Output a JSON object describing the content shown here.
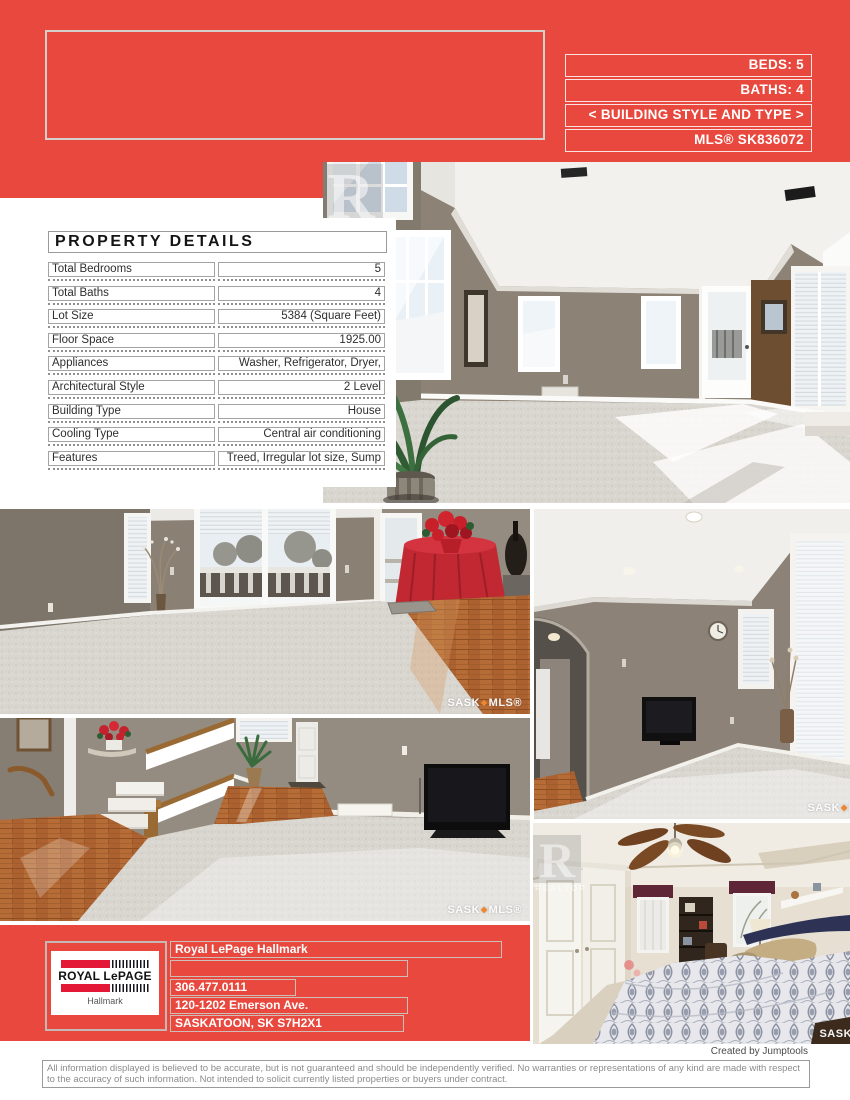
{
  "colors": {
    "accent_red": "#e8483d",
    "brand_red": "#e31837"
  },
  "header": {
    "badges": [
      {
        "label": "BEDS: 5"
      },
      {
        "label": "BATHS: 4"
      },
      {
        "label": "< BUILDING STYLE AND TYPE >"
      },
      {
        "label": "MLS® SK836072"
      }
    ]
  },
  "property_details": {
    "title": "PROPERTY DETAILS",
    "rows": [
      {
        "label": "Total Bedrooms",
        "value": "5"
      },
      {
        "label": "Total Baths",
        "value": "4"
      },
      {
        "label": "Lot Size",
        "value": "5384 (Square Feet)"
      },
      {
        "label": "Floor Space",
        "value": "1925.00"
      },
      {
        "label": "Appliances",
        "value": "Washer, Refrigerator, Dryer,"
      },
      {
        "label": "Architectural Style",
        "value": "2 Level"
      },
      {
        "label": "Building Type",
        "value": "House"
      },
      {
        "label": "Cooling Type",
        "value": "Central air conditioning"
      },
      {
        "label": "Features",
        "value": "Treed, Irregular lot size, Sump"
      }
    ]
  },
  "photos": {
    "watermark": {
      "prefix": "SASK",
      "diamond": "◆",
      "suffix": "MLS®"
    },
    "realtor_watermark": {
      "letter": "R",
      "label": "REALTOR"
    }
  },
  "footer": {
    "logo": {
      "name": "ROYAL LePAGE",
      "division": "Hallmark"
    },
    "office_name": "Royal LePage Hallmark",
    "phone": "306.477.0111",
    "address_line1": "120-1202 Emerson Ave.",
    "address_line2": "SASKATOON, SK S7H2X1"
  },
  "credits": {
    "created_by": "Created by Jumptools"
  },
  "disclaimer": "All information displayed is believed to be accurate, but is not guaranteed and should be independently verified. No warranties or representations of any kind are made with respect to the accuracy of such information. Not intended to solicit currently listed properties or buyers under contract."
}
